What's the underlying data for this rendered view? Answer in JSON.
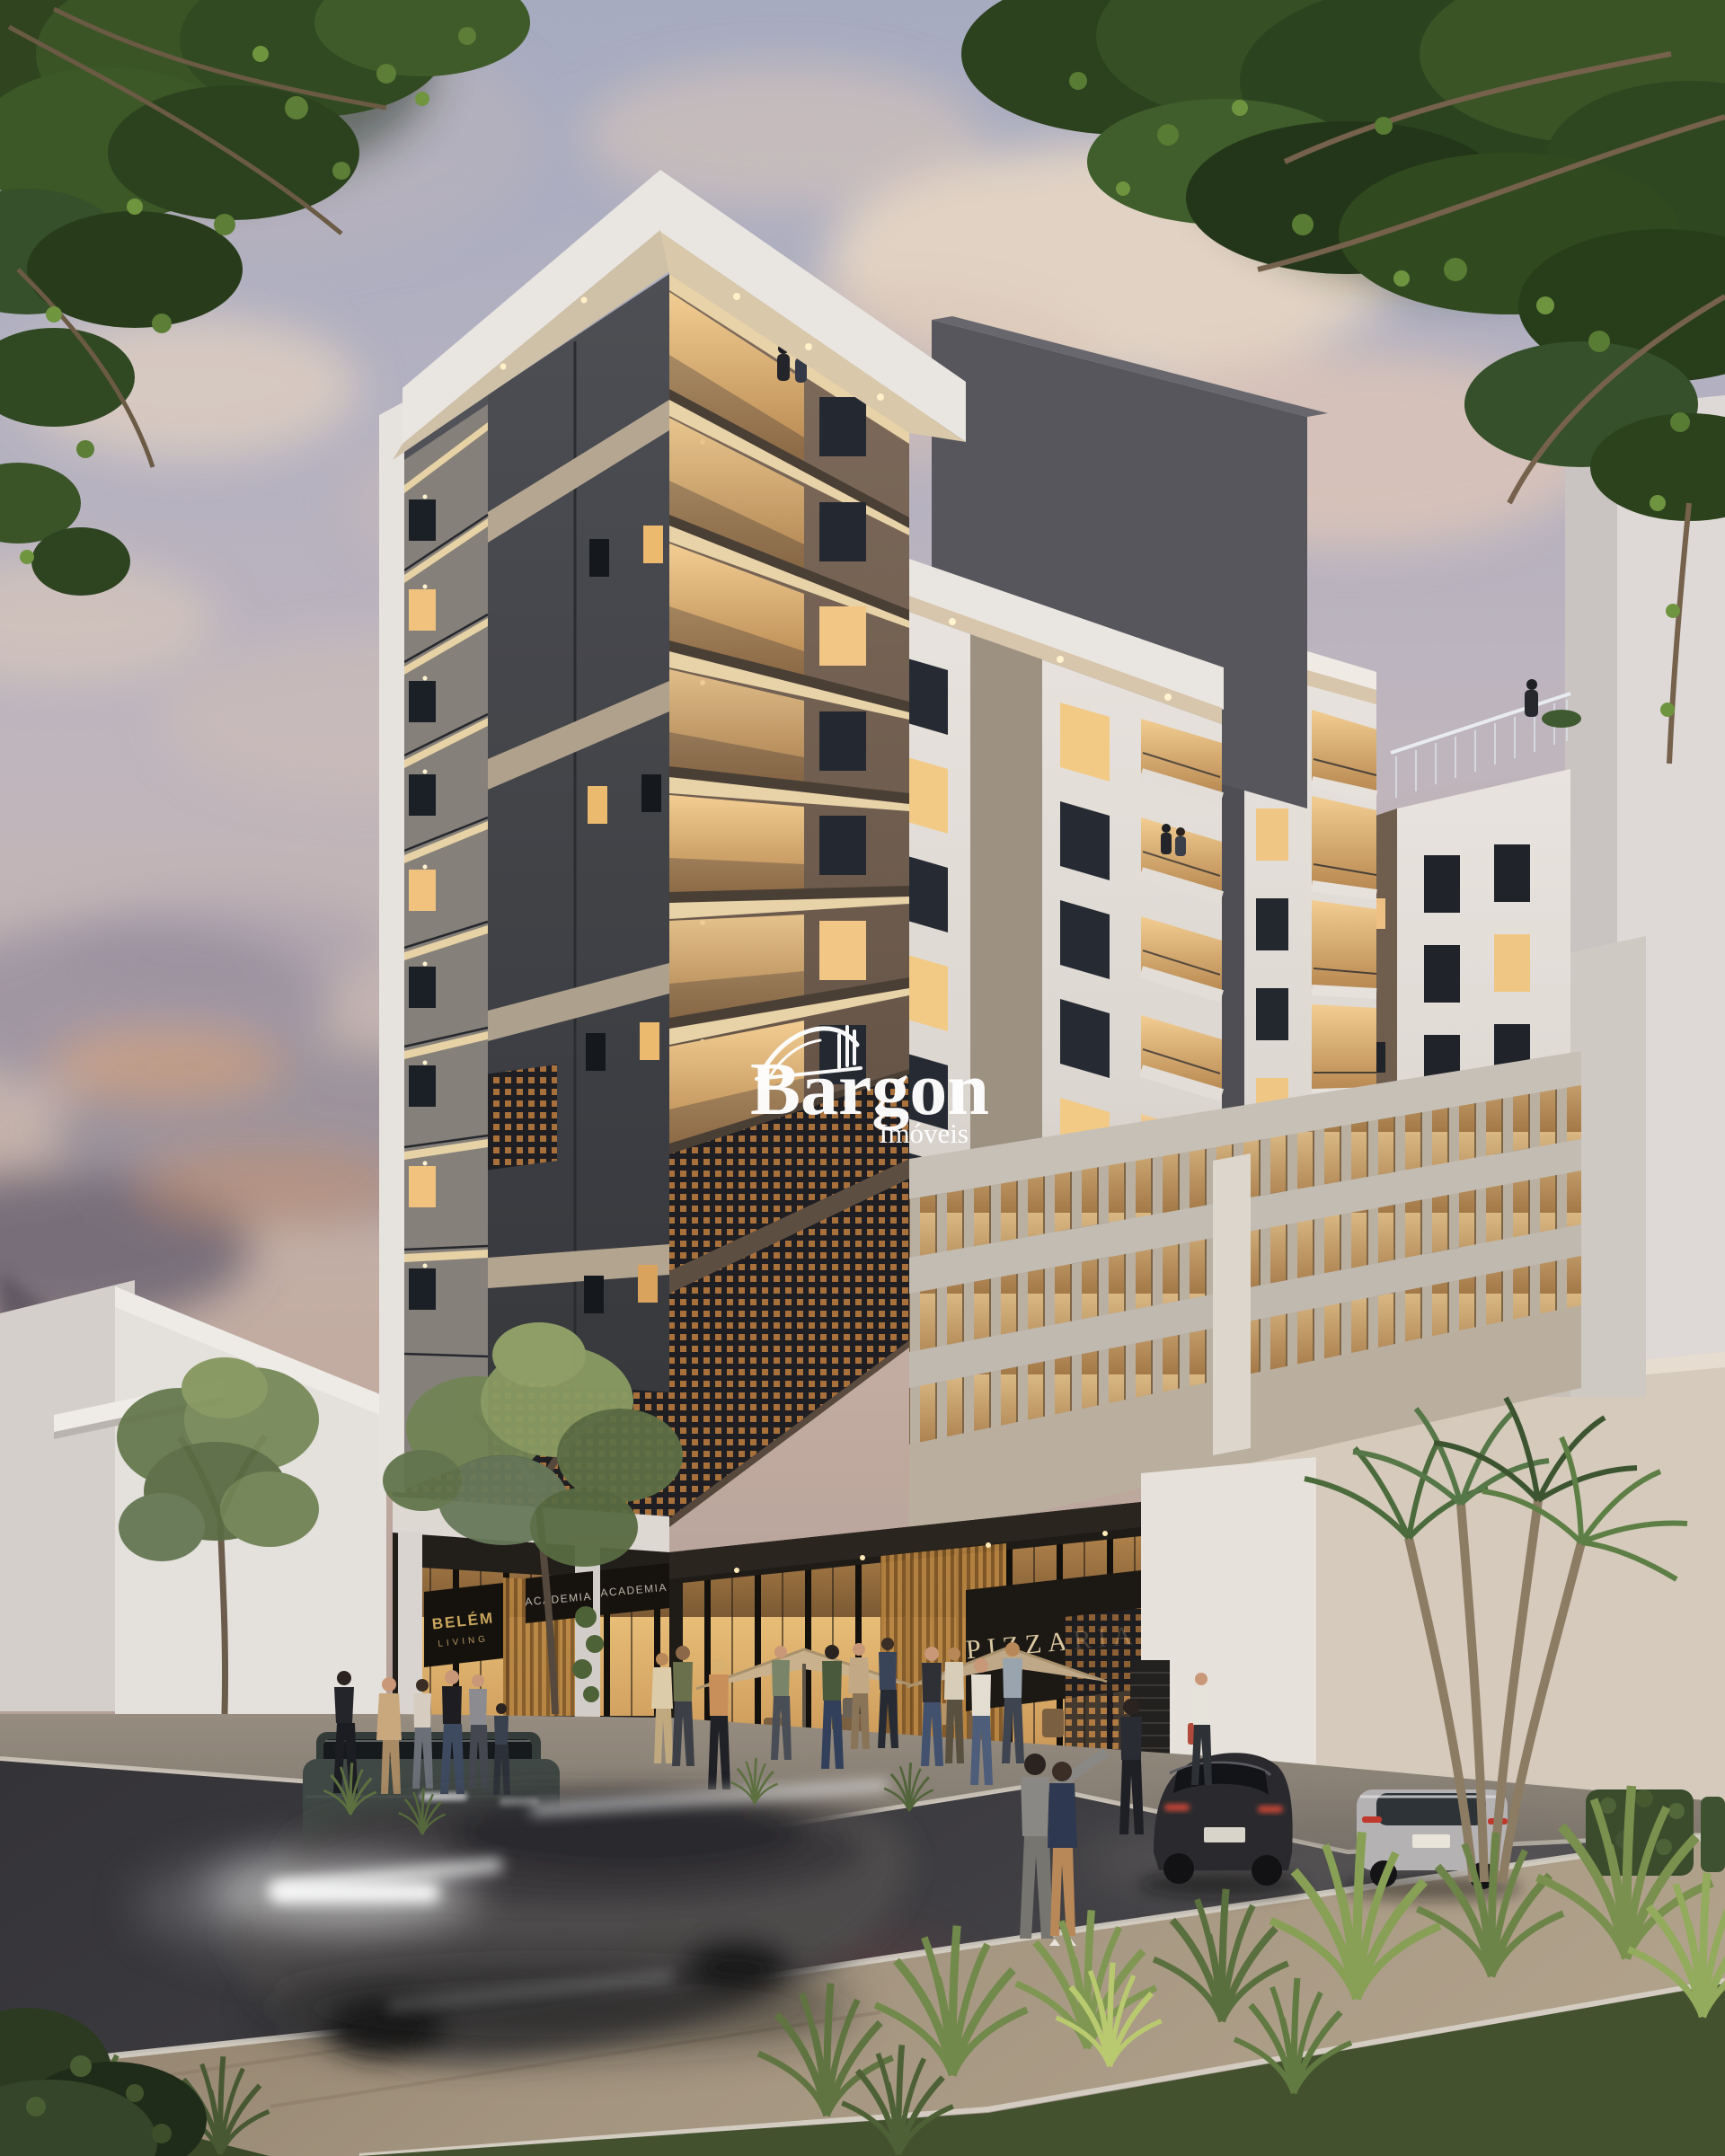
{
  "watermark": {
    "brand": "Bargon",
    "subtitle": "Imóveis",
    "icon": "bridge-skyline-logo-icon",
    "color": "#ffffff"
  },
  "signs": {
    "residential_line1": "BELÉM",
    "residential_line2": "LIVING",
    "gym_left": "ACADEMIA",
    "gym_right": "ACADEMIA",
    "pizzeria": "PIZZARIA",
    "gold": "#c9a55e",
    "gold_dim": "#b2945f",
    "light": "#d6cdbf",
    "cream": "#dcc9a2"
  },
  "palette": {
    "sky_top": "#a6abc0",
    "sky_warm": "#c5b4ae",
    "cloud_cream": "#ead8c4",
    "cloud_dark": "#665f6e",
    "sunset_orange": "#d1946a",
    "facade_white": "#e6e1dc",
    "facade_charcoal": "#45474c",
    "facade_brown": "#6e5c4e",
    "accent_beige": "#b3a491",
    "window_lit": "#f0c684",
    "window_dark": "#20242a",
    "asphalt": "#3b3a3e",
    "sidewalk_tan": "#9a8a76",
    "foliage_dark": "#2c411e",
    "palm_green": "#4c6b3c"
  }
}
